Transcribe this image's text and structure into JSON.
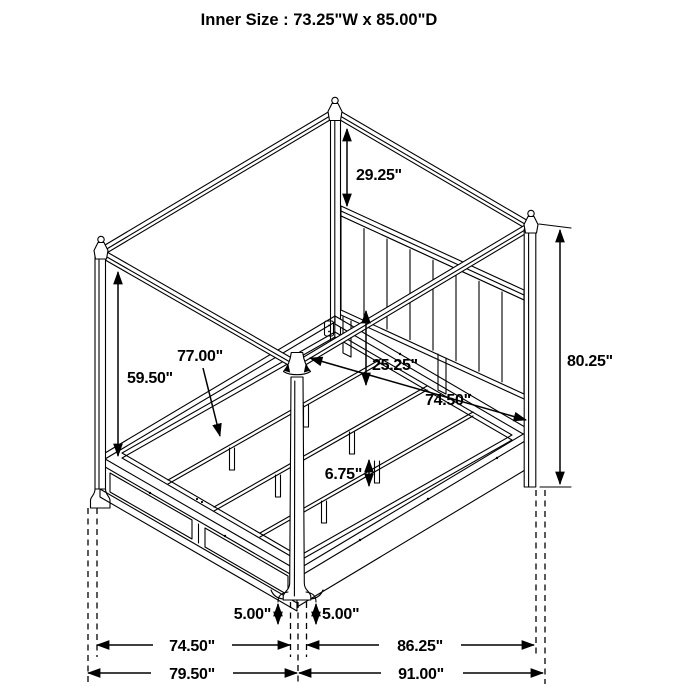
{
  "title": "Inner Size : 73.25\"W x 85.00\"D",
  "product": "four-poster-canopy-storage-bed-dimension-diagram",
  "colors": {
    "line": "#000000",
    "background": "#ffffff",
    "text": "#000000"
  },
  "dimensions": {
    "canopy_post_upper": "29.25\"",
    "overall_height": "80.25\"",
    "foot_post_height": "59.50\"",
    "slat_rail_length": "77.00\"",
    "headboard_clearance": "25.25\"",
    "side_rail_length": "74.50\"",
    "support_leg_height": "6.75\"",
    "post_base_left": "5.00\"",
    "post_base_right": "5.00\"",
    "footboard_width": "74.50\"",
    "side_depth": "86.25\"",
    "overall_width": "79.50\"",
    "overall_depth": "91.00\""
  }
}
